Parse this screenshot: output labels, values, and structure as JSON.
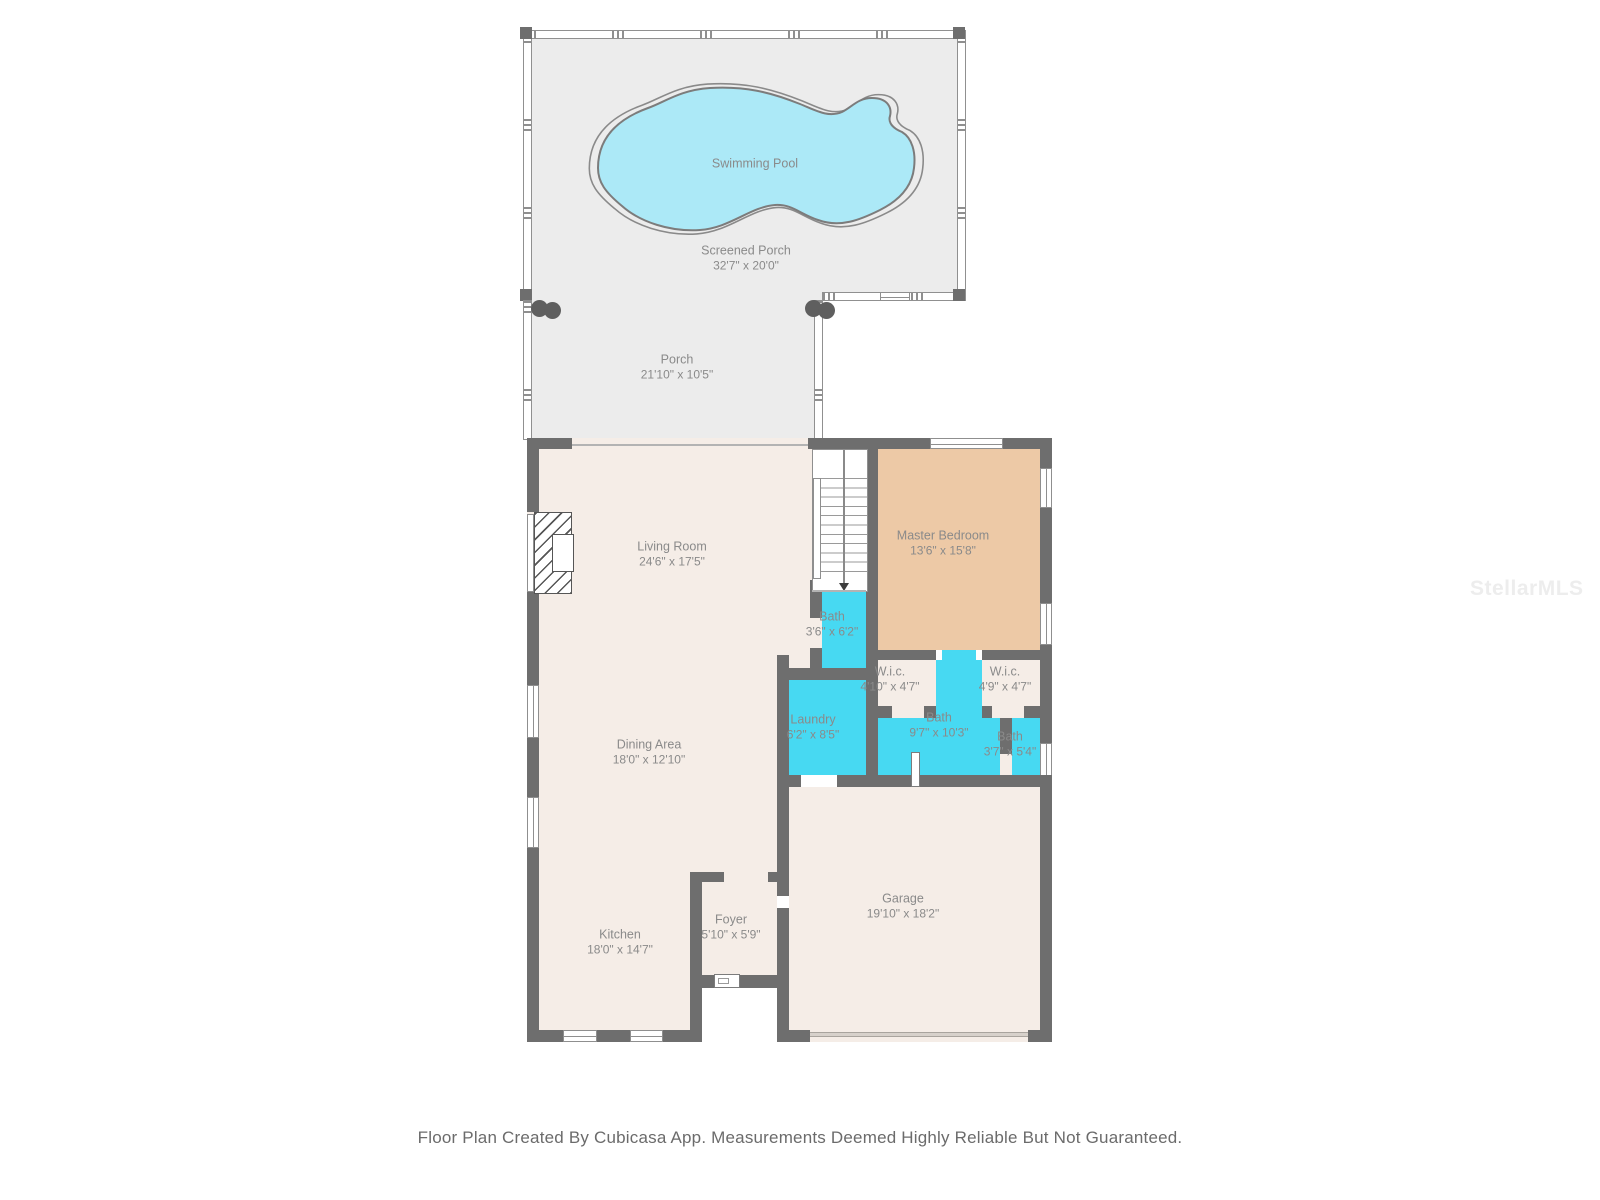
{
  "page": {
    "footer": "Floor Plan Created By Cubicasa App. Measurements Deemed Highly Reliable But Not Guaranteed.",
    "watermark": "StellarMLS"
  },
  "colors": {
    "wall": "#6e6e6e",
    "floor_interior": "#f5ede7",
    "floor_master": "#edc9a6",
    "floor_wet": "#47d9f2",
    "floor_porch": "#ececec",
    "pool_fill": "#ace9f7",
    "label_text": "#8a8a8a"
  },
  "rooms": {
    "swimming_pool": {
      "name": "Swimming Pool",
      "dims": ""
    },
    "screened_porch": {
      "name": "Screened Porch",
      "dims": "32'7\" x 20'0\""
    },
    "porch": {
      "name": "Porch",
      "dims": "21'10\" x 10'5\""
    },
    "living_room": {
      "name": "Living Room",
      "dims": "24'6\" x 17'5\""
    },
    "master_bedroom": {
      "name": "Master Bedroom",
      "dims": "13'6\" x 15'8\""
    },
    "bath_stairs": {
      "name": "Bath",
      "dims": "3'6\" x 6'2\""
    },
    "wic_left": {
      "name": "W.i.c.",
      "dims": "4'10\" x 4'7\""
    },
    "wic_right": {
      "name": "W.i.c.",
      "dims": "4'9\" x 4'7\""
    },
    "laundry": {
      "name": "Laundry",
      "dims": "6'2\" x 8'5\""
    },
    "bath_main": {
      "name": "Bath",
      "dims": "9'7\" x 10'3\""
    },
    "bath_small": {
      "name": "Bath",
      "dims": "3'7\" x 5'4\""
    },
    "dining_area": {
      "name": "Dining Area",
      "dims": "18'0\" x 12'10\""
    },
    "kitchen": {
      "name": "Kitchen",
      "dims": "18'0\" x 14'7\""
    },
    "foyer": {
      "name": "Foyer",
      "dims": "5'10\" x 5'9\""
    },
    "garage": {
      "name": "Garage",
      "dims": "19'10\" x 18'2\""
    }
  }
}
